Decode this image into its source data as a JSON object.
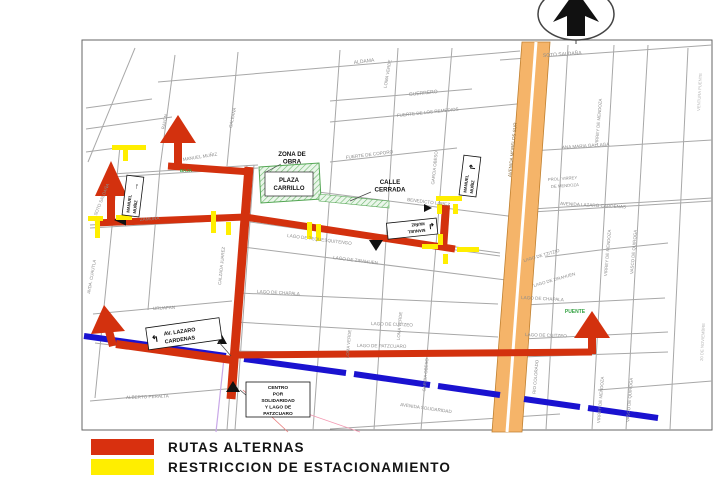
{
  "page": {
    "background": "#ffffff"
  },
  "legend": {
    "items": [
      {
        "label": "RUTAS ALTERNAS",
        "color": "#d8300f"
      },
      {
        "label": "RESTRICCION DE ESTACIONAMIENTO",
        "color": "#ffee00"
      }
    ]
  },
  "map": {
    "colors": {
      "route_red": "#d3310e",
      "restriction_yellow": "#ffee00",
      "avenue_orange": "#f5b469",
      "avenue_blue": "#1a12d0",
      "closed_green": "#53a653",
      "street_gray": "#a8a8a8"
    },
    "compass": {
      "label": "north-arrow"
    },
    "callouts": {
      "zona_de_obra": {
        "line1": "ZONA DE",
        "line2": "OBRA"
      },
      "plaza_carrillo": {
        "line1": "PLAZA",
        "line2": "CARRILLO"
      },
      "calle_cerrada": {
        "line1": "CALLE",
        "line2": "CERRADA"
      },
      "puente": "PUENTE",
      "baja": "BAJA",
      "centro_sign": {
        "lines": [
          "CENTRO",
          "POR",
          "SOLIDARIDAD",
          "Y LAGO DE",
          "PATZCUARO"
        ]
      }
    },
    "traffic_signs": {
      "muniz_left": {
        "line1": "MANUEL",
        "line2": "MUÑIZ",
        "arrow": "→"
      },
      "muniz_right": {
        "line1": "MANUEL",
        "line2": "MUÑIZ",
        "arrow": "↱"
      },
      "muniz_center": {
        "line1": "MANUEL",
        "line2": "MUÑIZ",
        "arrow": "↲"
      },
      "lazaro": {
        "line1": "AV. LAZARO",
        "line2": "CARDENAS",
        "arrow": "↰"
      }
    },
    "avenue_label": {
      "text": "AVENIDA MORELOS SUR"
    },
    "street_labels": [
      "SOTO SALDAÑA",
      "ALDAMA",
      "GUERRERO",
      "FUERTE DE LOS REMEDIOS",
      "FUERTE DE COPORO",
      "ANA MARIA GALLAGA",
      "AVENIDA LAZARO CARDENAS",
      "MANUEL MUÑIZ",
      "ZAMORA",
      "BENEDICTO LOPEZ",
      "LAGO DE TEQUESQUITENGO",
      "LAGO DE ZIRAHUEN",
      "LAGO DE CHAPALA",
      "LAGO DE CHAPALA",
      "LAGO DE ZIRAHUEN",
      "LAGO DE TZITZIO",
      "LAGO DE CUITZEO",
      "LAGO DE CUITZEO",
      "LAGO DE PATZCUARO",
      "URUAPAN",
      "ALBERTO PERALTA",
      "AVENIDA SOLIDARIDAD",
      "RAYON",
      "GALEANA",
      "LOMA VERDE",
      "GARCIA OBESO",
      "CALZADA JUAREZ",
      "AVDA. CUAUTLA",
      "VIRREY DE MENDOZA",
      "VIRREY DE MENDOZA",
      "VASCO DE QUIROGA",
      "VIRREY DE MENDOZA",
      "VASCO DE QUIROGA",
      "RIO COLORADO",
      "GARCIA OBESO",
      "LOMA VERDE",
      "LOMA VERDE",
      "SOTO SALDAÑA",
      "VENTURA PUENTE",
      "20 DE NOVIEMBRE",
      "PROL. VIRREY",
      "DE MENDOZA"
    ]
  }
}
